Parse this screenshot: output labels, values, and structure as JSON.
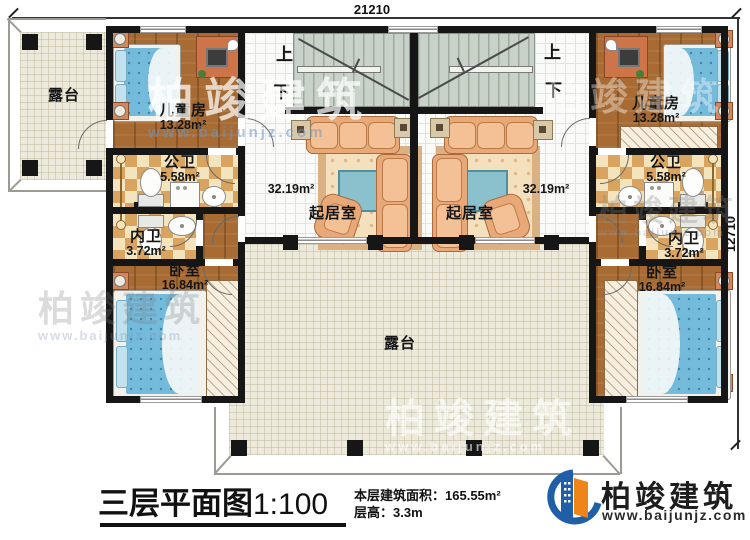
{
  "plan": {
    "dim_width": "21210",
    "dim_height": "12710",
    "stairs": {
      "up": "上",
      "down": "下"
    },
    "rooms": {
      "terrace_left": {
        "name": "露台"
      },
      "terrace_bottom": {
        "name": "露台"
      },
      "children_left": {
        "name": "儿童房",
        "area": "13.28m²"
      },
      "children_right": {
        "name": "儿童房",
        "area": "13.28m²"
      },
      "bath_public_left": {
        "name": "公卫",
        "area": "5.58m²"
      },
      "bath_public_right": {
        "name": "公卫",
        "area": "5.58m²"
      },
      "bath_inner_left": {
        "name": "内卫",
        "area": "3.72m²"
      },
      "bath_inner_right": {
        "name": "内卫",
        "area": "3.72m²"
      },
      "living_left": {
        "name": "起居室",
        "area": "32.19m²"
      },
      "living_right": {
        "name": "起居室",
        "area": "32.19m²"
      },
      "bedroom_left": {
        "name": "卧室",
        "area": "16.84m²"
      },
      "bedroom_right": {
        "name": "卧室",
        "area": "16.84m²"
      }
    },
    "title": {
      "text": "三层平面图",
      "scale": "1:100"
    },
    "info": {
      "area_label": "本层建筑面积：",
      "area_value": "165.55m²",
      "height_label": "层高：",
      "height_value": "3.3m"
    }
  },
  "branding": {
    "company": "柏竣建筑",
    "website": "www.baijunjz.com"
  }
}
